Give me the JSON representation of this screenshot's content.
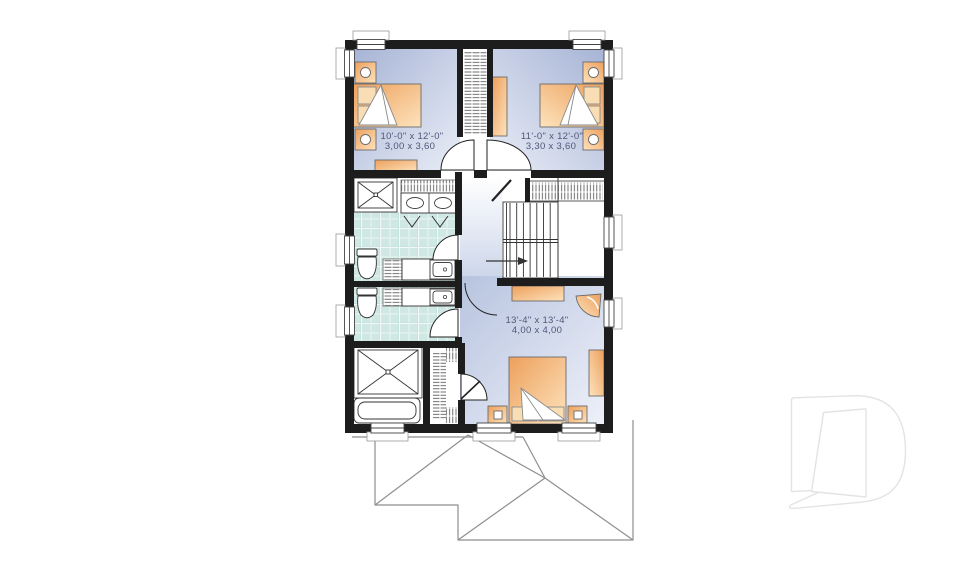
{
  "page": {
    "background": "#ffffff",
    "type": "floor-plan-drawing"
  },
  "floor_plan": {
    "rooms": {
      "bedroom_1": {
        "imperial": "10'-0\" x 12'-0\"",
        "metric": "3,00 x 3,60"
      },
      "bedroom_2": {
        "imperial": "11'-0\" x 12'-0\"",
        "metric": "3,30 x 3,60"
      },
      "bedroom_3": {
        "imperial": "13'-4\" x 13'-4\"",
        "metric": "4,00 x 4,00"
      }
    },
    "symbols": [
      "bed-icon",
      "nightstand-icon",
      "dresser-icon",
      "shower-icon",
      "bathtub-icon",
      "toilet-icon",
      "double-vanity-icon",
      "sink-icon",
      "closet-hatch-icon",
      "stairs-icon",
      "stair-direction-arrow-icon",
      "door-swing-icon",
      "window-icon",
      "corner-chair-icon",
      "roof-outline-icon",
      "drummond-d-logo-icon"
    ],
    "colors": {
      "wall": "#1d1d1d",
      "bedroom_floor_dark": "#a7b4d6",
      "bedroom_floor_light": "#e9edf6",
      "tile": "#cfe8e3",
      "tile_grout": "#ffffff",
      "furniture_dark": "#eda05c",
      "furniture_light": "#fde3bd",
      "label_text": "#4d5878",
      "roof_line": "#8e8e8e",
      "logo_line": "#e3e3e3"
    }
  }
}
